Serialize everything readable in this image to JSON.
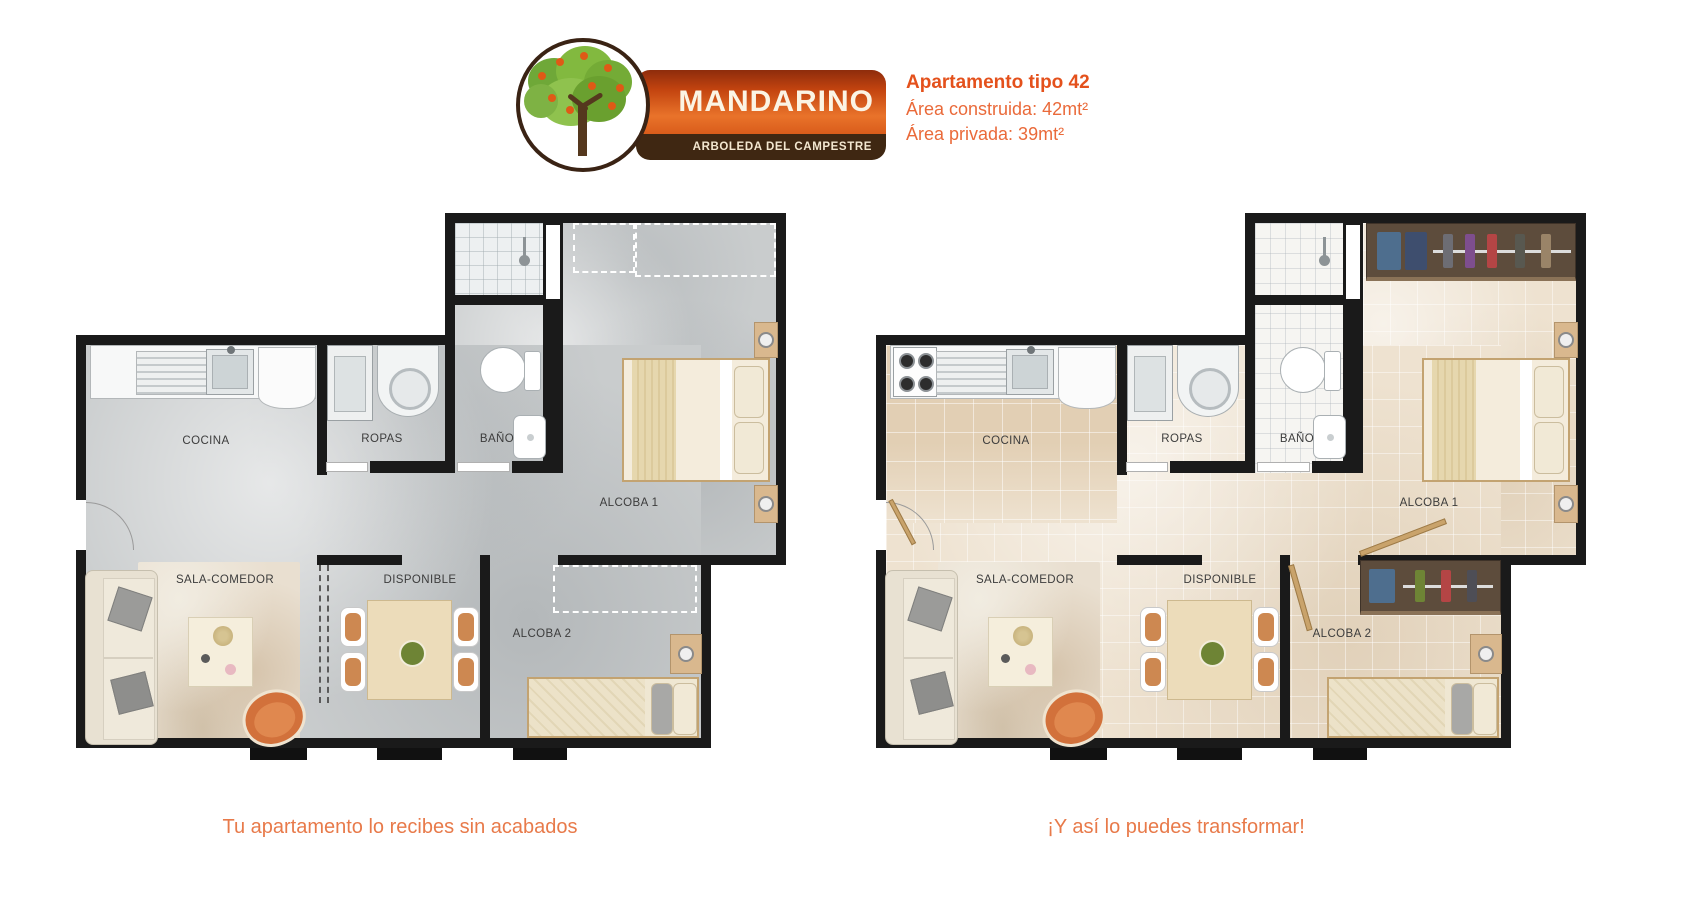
{
  "header": {
    "brand": "MANDARINO",
    "tagline": "ARBOLEDA DEL CAMPESTRE",
    "apartment_title": "Apartamento tipo 42",
    "area_built": "Área construida: 42mt²",
    "area_private": "Área privada: 39mt²"
  },
  "plans": [
    {
      "variant": "sin_acabados",
      "caption": "Tu apartamento lo recibes sin acabados",
      "rooms": [
        {
          "label": "COCINA"
        },
        {
          "label": "ROPAS"
        },
        {
          "label": "BAÑO"
        },
        {
          "label": "ALCOBA 1"
        },
        {
          "label": "SALA-COMEDOR"
        },
        {
          "label": "DISPONIBLE"
        },
        {
          "label": "ALCOBA 2"
        }
      ]
    },
    {
      "variant": "transformado",
      "caption": "¡Y así lo puedes transformar!",
      "rooms": [
        {
          "label": "COCINA"
        },
        {
          "label": "ROPAS"
        },
        {
          "label": "BAÑO"
        },
        {
          "label": "ALCOBA 1"
        },
        {
          "label": "SALA-COMEDOR"
        },
        {
          "label": "DISPONIBLE"
        },
        {
          "label": "ALCOBA 2"
        }
      ]
    }
  ],
  "colors": {
    "accent_orange": "#E8622D",
    "banner_gradient_top": "#8E2C0C",
    "banner_gradient_bottom": "#D95C1B",
    "brown_bar": "#3F2712",
    "wall": "#1A1A1A",
    "floor_raw": "#C9CCCD",
    "floor_finished": "#EEE2D0"
  }
}
